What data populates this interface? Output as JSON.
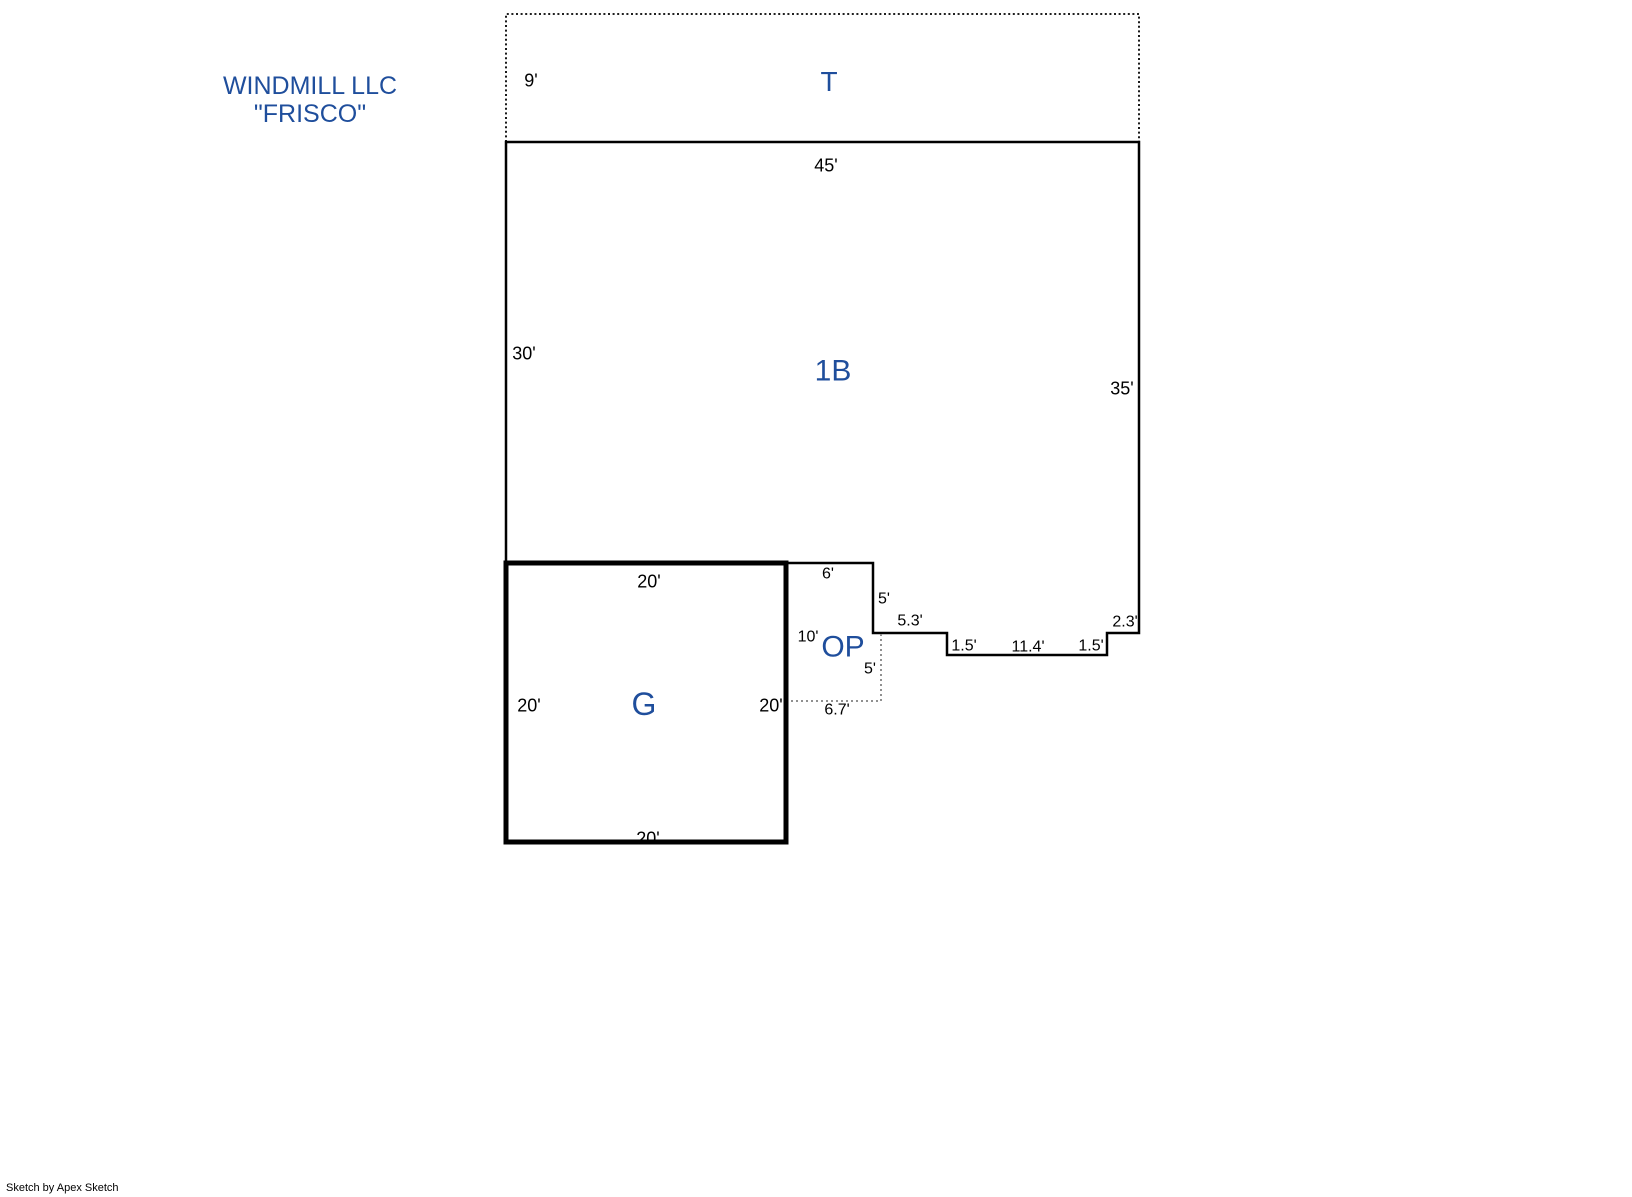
{
  "header": {
    "title_line1": "WINDMILL LLC",
    "title_line2": "\"FRISCO\""
  },
  "areas": {
    "t": "T",
    "b1": "1B",
    "g": "G",
    "op": "OP"
  },
  "dims": {
    "t_left": "9'",
    "b1_top": "45'",
    "b1_left": "30'",
    "b1_right": "35'",
    "g_top": "20'",
    "g_left": "20'",
    "g_right": "20'",
    "g_bottom": "20'",
    "op_top": "6'",
    "op_upper_right": "5'",
    "op_left": "10'",
    "op_lower_right": "5'",
    "op_bottom": "6.7'",
    "step_a": "5.3'",
    "step_b": "1.5'",
    "step_c": "11.4'",
    "step_d": "1.5'",
    "step_e": "2.3'"
  },
  "footer": {
    "credit": "Sketch by Apex Sketch"
  },
  "colors": {
    "area_label_blue": "#1f4e9c",
    "line_black": "#000000",
    "porch_dotted_gray": "#909090"
  }
}
